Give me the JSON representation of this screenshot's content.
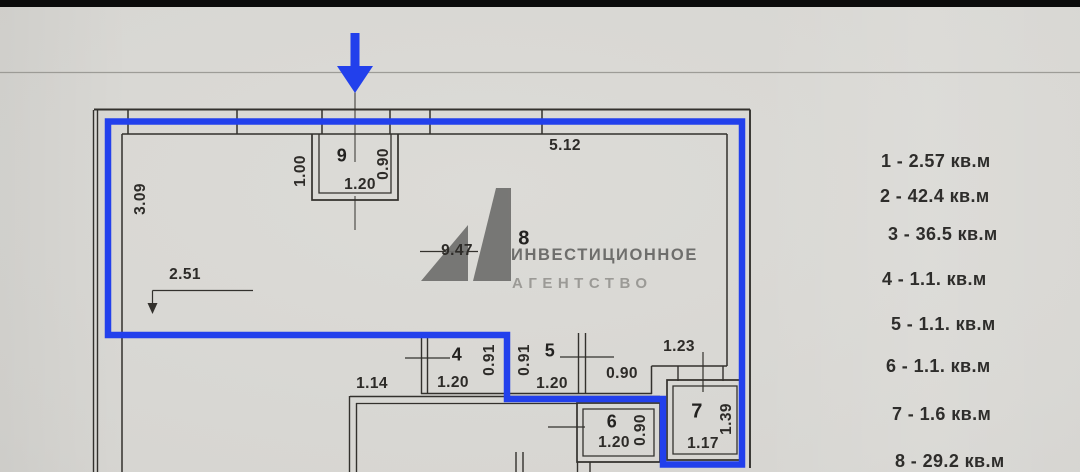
{
  "colors": {
    "highlight_blue": "#2240ec",
    "paper": "#d8d7d3",
    "ink": "#32302c",
    "watermark_gray": "#6f6f6d"
  },
  "watermark": {
    "logo": "A1-monogram",
    "line1": "ИНВЕСТИЦИОННОЕ",
    "line2": "АГЕНТСТВО"
  },
  "legend": {
    "items": [
      "1 - 2.57 кв.м",
      "2 - 42.4 кв.м",
      "3 - 36.5 кв.м",
      "4 - 1.1. кв.м",
      "5 - 1.1. кв.м",
      "6 - 1.1. кв.м",
      "7 - 1.6 кв.м",
      "8 - 29.2 кв.м"
    ]
  },
  "plan": {
    "rooms": {
      "r4": "4",
      "r5": "5",
      "r6": "6",
      "r7": "7",
      "r8": "8",
      "r9": "9"
    },
    "dims": {
      "v309": "3.09",
      "v100": "1.00",
      "v090_r9": "0.90",
      "v120_r9": "1.20",
      "v512": "5.12",
      "v251": "2.51",
      "v947": "9.47",
      "v114": "1.14",
      "v120_r4": "1.20",
      "v091_r4": "0.91",
      "v091_r5": "0.91",
      "v120_r5": "1.20",
      "v090_hall": "0.90",
      "v123": "1.23",
      "v120_r6": "1.20",
      "v090_r6": "0.90",
      "v139": "1.39",
      "v117": "1.17"
    }
  }
}
